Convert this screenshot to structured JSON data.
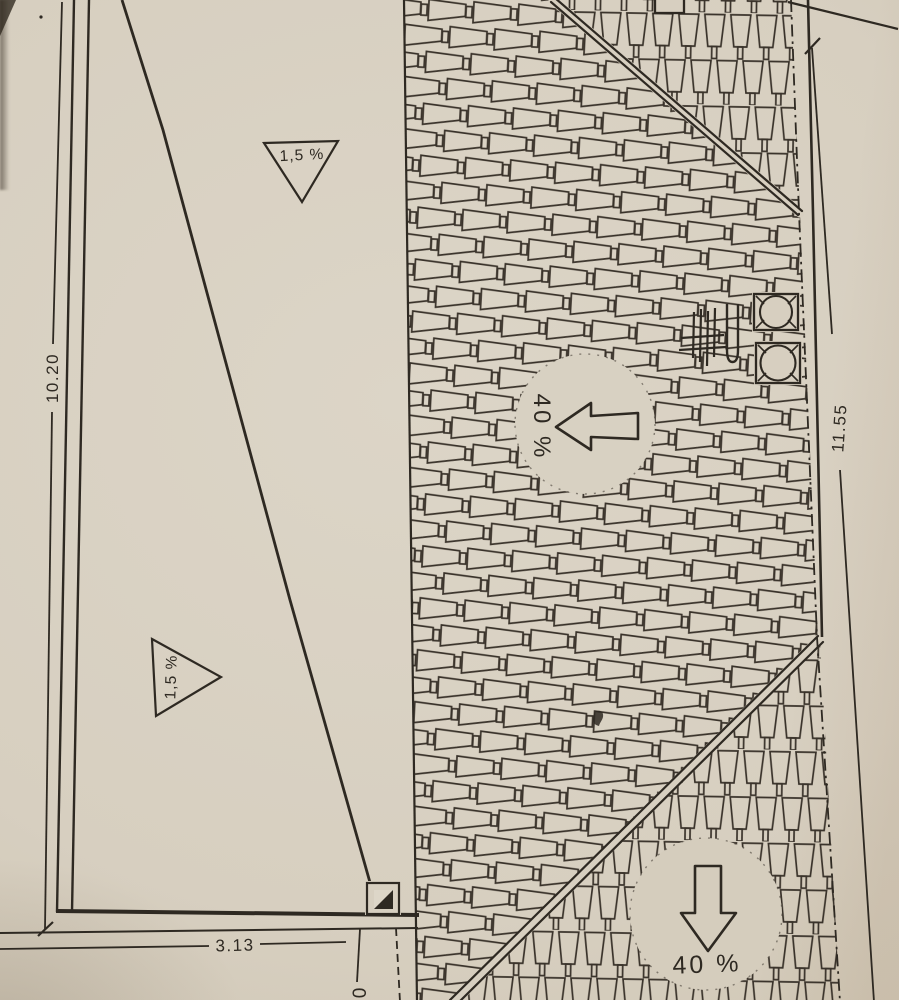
{
  "colors": {
    "paper": "#d7cfc0",
    "ink": "#2e2922"
  },
  "dimensions": {
    "left_vertical": "10.20",
    "right_vertical": "11.55",
    "bottom_horizontal": "3.13",
    "bottom_partial": "0"
  },
  "slopes": {
    "flat_top": "1,5 %",
    "flat_lower": "1,5 %",
    "main_left": "40 %",
    "south": "40 %"
  }
}
